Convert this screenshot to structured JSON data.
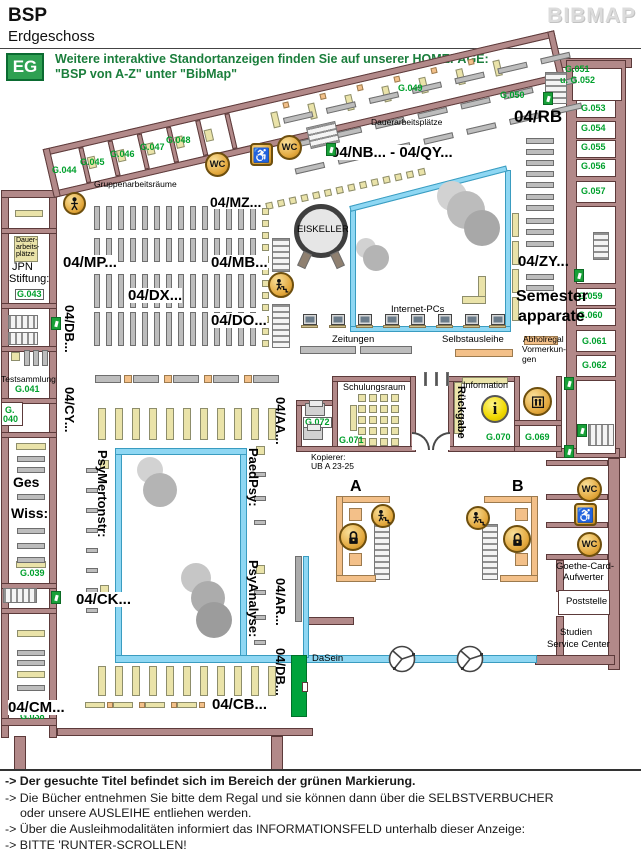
{
  "header": {
    "title": "BSP",
    "subtitle": "Erdgeschoss",
    "brand": "BIBMAP"
  },
  "notice": {
    "badge": "EG",
    "line1": "Weitere interaktive Standortanzeigen finden Sie auf unserer HOMEPAGE:",
    "line2": "\"BSP von A-Z\" unter \"BibMap\""
  },
  "legend_footer": {
    "lines": [
      {
        "text": "-> Der gesuchte Titel befindet sich im Bereich der grünen Markierung."
      },
      {
        "text": "-> Die Bücher entnehmen Sie bitte dem Regal und sie können dann über die SELBSTVERBUCHER"
      },
      {
        "text": "oder unsere AUSLEIHE entliehen werden."
      },
      {
        "text": "-> Über die Ausleihmodalitäten informiert das INFORMATIONSFELD unterhalb dieser Anzeige:"
      },
      {
        "text": "-> BITTE 'RUNTER-SCROLLEN!"
      }
    ]
  },
  "colors": {
    "wall": "#b28989",
    "glass_blue": "#8ed7f3",
    "marking_green": "#00a33c",
    "furniture_yellow": "#eae3a9",
    "shelf_gray": "#bdbdbd",
    "accent_orange": "#f3c089",
    "icon_gold": "#eec055",
    "room_label_green": "#00a02c",
    "notice_green": "#1b7e3c"
  },
  "map": {
    "marking": {
      "shelf": "04/DB...",
      "note": "green marking = location of searched title"
    },
    "labels": [
      {
        "t": "Gruppenarbeitsräume",
        "x": 94,
        "y": 180,
        "c": "S",
        "fs": 8.5
      },
      {
        "t": "Dauerarbeitsplätze",
        "x": 371,
        "y": 118,
        "c": "S",
        "fs": 8.5
      },
      {
        "t": "EISKELLER",
        "x": 297,
        "y": 225,
        "c": "S",
        "fs": 9.5,
        "n": "eiskeller-label"
      },
      {
        "t": "Internet-PCs",
        "x": 391,
        "y": 305,
        "c": "S",
        "fs": 9.5
      },
      {
        "t": "Zeitungen",
        "x": 332,
        "y": 335,
        "c": "S",
        "fs": 9.5
      },
      {
        "t": "Selbstausleihe",
        "x": 442,
        "y": 335,
        "c": "S",
        "fs": 9.5
      },
      {
        "t": "Abholregal",
        "x": 523,
        "y": 335,
        "c": "S",
        "fs": 8.5
      },
      {
        "t": "Vormerkun-",
        "x": 522,
        "y": 345,
        "c": "S",
        "fs": 8.5
      },
      {
        "t": "gen",
        "x": 522,
        "y": 355,
        "c": "S",
        "fs": 8.5
      },
      {
        "t": "Schulungsraum",
        "x": 343,
        "y": 383,
        "c": "S",
        "fs": 9
      },
      {
        "t": "Information",
        "x": 463,
        "y": 381,
        "c": "S",
        "fs": 9
      },
      {
        "t": "Kopierer:",
        "x": 311,
        "y": 453,
        "c": "S",
        "fs": 8.5
      },
      {
        "t": "UB A 23-25",
        "x": 311,
        "y": 462,
        "c": "S",
        "fs": 8.5
      },
      {
        "t": "DaSein",
        "x": 312,
        "y": 654,
        "c": "S",
        "fs": 9.5
      },
      {
        "t": "Goethe-Card-",
        "x": 556,
        "y": 562,
        "c": "S",
        "fs": 9.5
      },
      {
        "t": "Aufwerter",
        "x": 563,
        "y": 573,
        "c": "S",
        "fs": 9.5
      },
      {
        "t": "Poststelle",
        "x": 566,
        "y": 597,
        "c": "S",
        "fs": 9.5
      },
      {
        "t": "Studien",
        "x": 560,
        "y": 628,
        "c": "S",
        "fs": 9.5
      },
      {
        "t": "Service Center",
        "x": 547,
        "y": 640,
        "c": "S",
        "fs": 9.5
      },
      {
        "t": "JPN",
        "x": 12,
        "y": 262,
        "c": "S",
        "fs": 11
      },
      {
        "t": "Stiftung:",
        "x": 9,
        "y": 274,
        "c": "S",
        "fs": 11
      },
      {
        "t": "Testsammlung",
        "x": 1,
        "y": 375,
        "c": "S",
        "fs": 8.5
      },
      {
        "t": "Dauer-",
        "x": 16,
        "y": 237,
        "c": "S",
        "fs": 7
      },
      {
        "t": "arbeits-",
        "x": 16,
        "y": 244,
        "c": "S",
        "fs": 7
      },
      {
        "t": "plätze",
        "x": 16,
        "y": 251,
        "c": "S",
        "fs": 7
      },
      {
        "t": "G.044",
        "x": 52,
        "y": 166,
        "c": "G"
      },
      {
        "t": "G.045",
        "x": 80,
        "y": 158,
        "c": "G"
      },
      {
        "t": "G.046",
        "x": 110,
        "y": 150,
        "c": "G"
      },
      {
        "t": "G.047",
        "x": 140,
        "y": 143,
        "c": "G"
      },
      {
        "t": "G.048",
        "x": 166,
        "y": 136,
        "c": "G"
      },
      {
        "t": "G.049",
        "x": 398,
        "y": 84,
        "c": "G"
      },
      {
        "t": "G.050",
        "x": 500,
        "y": 91,
        "c": "G"
      },
      {
        "t": "G.051",
        "x": 565,
        "y": 65,
        "c": "G"
      },
      {
        "t": "u. G.052",
        "x": 560,
        "y": 76,
        "c": "G"
      },
      {
        "t": "G.053",
        "x": 581,
        "y": 104,
        "c": "G"
      },
      {
        "t": "G.054",
        "x": 581,
        "y": 124,
        "c": "G"
      },
      {
        "t": "G.055",
        "x": 581,
        "y": 143,
        "c": "G"
      },
      {
        "t": "G.056",
        "x": 581,
        "y": 162,
        "c": "G"
      },
      {
        "t": "G.057",
        "x": 581,
        "y": 187,
        "c": "G"
      },
      {
        "t": "G.059",
        "x": 578,
        "y": 292,
        "c": "G"
      },
      {
        "t": "G.060",
        "x": 578,
        "y": 311,
        "c": "G"
      },
      {
        "t": "G.061",
        "x": 582,
        "y": 337,
        "c": "G"
      },
      {
        "t": "G.062",
        "x": 582,
        "y": 361,
        "c": "G"
      },
      {
        "t": "G.043",
        "x": 15,
        "y": 289,
        "c": "G",
        "box": true
      },
      {
        "t": "G.041",
        "x": 15,
        "y": 385,
        "c": "G"
      },
      {
        "t": "G.",
        "x": 5,
        "y": 406,
        "c": "G"
      },
      {
        "t": "040",
        "x": 3,
        "y": 415,
        "c": "G"
      },
      {
        "t": "G.039",
        "x": 20,
        "y": 569,
        "c": "G"
      },
      {
        "t": "G.038",
        "x": 20,
        "y": 712,
        "c": "G"
      },
      {
        "t": "G.071",
        "x": 339,
        "y": 436,
        "c": "G"
      },
      {
        "t": "G.072",
        "x": 303,
        "y": 417,
        "c": "G",
        "box": true
      },
      {
        "t": "G.070",
        "x": 486,
        "y": 433,
        "c": "G"
      },
      {
        "t": "G.069",
        "x": 525,
        "y": 433,
        "c": "G"
      },
      {
        "t": "04/NB... - 04/QY...",
        "x": 331,
        "y": 145,
        "c": "B",
        "bg": "#fff"
      },
      {
        "t": "04/MZ...",
        "x": 210,
        "y": 195,
        "c": "B",
        "fs": 14,
        "bg": "#fff"
      },
      {
        "t": "04/RB",
        "x": 514,
        "y": 108,
        "c": "B",
        "fs": 17
      },
      {
        "t": "04/MP...",
        "x": 63,
        "y": 255,
        "c": "B",
        "bg": "#fff"
      },
      {
        "t": "04/MB...",
        "x": 211,
        "y": 255,
        "c": "B",
        "bg": "#fff"
      },
      {
        "t": "04/DX...",
        "x": 128,
        "y": 288,
        "c": "B",
        "bg": "#fff"
      },
      {
        "t": "04/DO...",
        "x": 211,
        "y": 313,
        "c": "B",
        "bg": "#fff"
      },
      {
        "t": "04/ZY...",
        "x": 518,
        "y": 254,
        "c": "B"
      },
      {
        "t": "Semester",
        "x": 516,
        "y": 289,
        "c": "B",
        "fs": 16
      },
      {
        "t": "apparate",
        "x": 518,
        "y": 309,
        "c": "B",
        "fs": 16
      },
      {
        "t": "04/CK...",
        "x": 76,
        "y": 592,
        "c": "B",
        "bg": "#fff"
      },
      {
        "t": "04/CM...",
        "x": 8,
        "y": 700,
        "c": "B",
        "bg": "#fff"
      },
      {
        "t": "04/CB...",
        "x": 212,
        "y": 697,
        "c": "B",
        "bg": "#fff"
      },
      {
        "t": "A",
        "x": 350,
        "y": 479,
        "c": "B",
        "fs": 16,
        "n": "staircase-a-label"
      },
      {
        "t": "B",
        "x": 512,
        "y": 479,
        "c": "B",
        "fs": 16,
        "n": "staircase-b-label"
      },
      {
        "t": "Ges",
        "x": 13,
        "y": 475,
        "c": "B",
        "fs": 14
      },
      {
        "t": "Wiss:",
        "x": 11,
        "y": 506,
        "c": "B",
        "fs": 14
      },
      {
        "t": "04/DB...",
        "x": 63,
        "y": 305,
        "c": "V"
      },
      {
        "t": "04/CY...",
        "x": 63,
        "y": 387,
        "c": "V"
      },
      {
        "t": "04/AA...",
        "x": 274,
        "y": 397,
        "c": "V"
      },
      {
        "t": "04/AR...",
        "x": 274,
        "y": 578,
        "c": "V"
      },
      {
        "t": "04/DB...",
        "x": 274,
        "y": 648,
        "c": "V",
        "n": "marked-shelf-label"
      },
      {
        "t": "PsyMertonstr:",
        "x": 96,
        "y": 450,
        "c": "V"
      },
      {
        "t": "PaedPsy:",
        "x": 247,
        "y": 448,
        "c": "V"
      },
      {
        "t": "PsyAnalyse:",
        "x": 247,
        "y": 560,
        "c": "V"
      },
      {
        "t": "Rückgabe",
        "x": 455,
        "y": 386,
        "c": "V",
        "fs": 11
      }
    ],
    "icons": [
      {
        "kind": "person",
        "name": "baby-changing-icon",
        "x": 63,
        "y": 192,
        "s": 23
      },
      {
        "kind": "wc",
        "name": "wc-icon",
        "x": 205,
        "y": 152,
        "s": 25
      },
      {
        "kind": "wheel",
        "name": "accessible-wc-icon",
        "x": 250,
        "y": 143,
        "s": 23
      },
      {
        "kind": "wc",
        "name": "wc-icon",
        "x": 277,
        "y": 135,
        "s": 25
      },
      {
        "kind": "stairp",
        "name": "stairs-up-icon",
        "x": 268,
        "y": 272,
        "s": 26
      },
      {
        "kind": "info",
        "name": "information-icon",
        "x": 481,
        "y": 395,
        "s": 28
      },
      {
        "kind": "elev",
        "name": "elevator-icon",
        "x": 523,
        "y": 387,
        "s": 29
      },
      {
        "kind": "lock",
        "name": "lock-icon",
        "x": 339,
        "y": 523,
        "s": 28
      },
      {
        "kind": "lock",
        "name": "lock-icon",
        "x": 503,
        "y": 525,
        "s": 28
      },
      {
        "kind": "stairp",
        "name": "stairs-up-icon",
        "x": 371,
        "y": 504,
        "s": 24
      },
      {
        "kind": "stairp",
        "name": "stairs-up-icon",
        "x": 466,
        "y": 506,
        "s": 24
      },
      {
        "kind": "wc",
        "name": "wc-icon",
        "x": 577,
        "y": 477,
        "s": 25
      },
      {
        "kind": "wheel",
        "name": "accessible-wc-icon",
        "x": 574,
        "y": 503,
        "s": 23
      },
      {
        "kind": "wc",
        "name": "wc-icon",
        "x": 577,
        "y": 532,
        "s": 25
      },
      {
        "kind": "exit",
        "name": "emergency-exit-icon",
        "x": 326,
        "y": 143
      },
      {
        "kind": "exit",
        "name": "emergency-exit-icon",
        "x": 543,
        "y": 92
      },
      {
        "kind": "exit",
        "name": "emergency-exit-icon",
        "x": 51,
        "y": 317
      },
      {
        "kind": "exit",
        "name": "emergency-exit-icon",
        "x": 51,
        "y": 591
      },
      {
        "kind": "exit",
        "name": "emergency-exit-icon",
        "x": 574,
        "y": 269
      },
      {
        "kind": "exit",
        "name": "emergency-exit-icon",
        "x": 564,
        "y": 377
      },
      {
        "kind": "exit",
        "name": "emergency-exit-icon",
        "x": 577,
        "y": 424
      },
      {
        "kind": "exit",
        "name": "emergency-exit-icon",
        "x": 564,
        "y": 445
      },
      {
        "kind": "printer",
        "name": "copier-icon",
        "x": 305,
        "y": 403
      },
      {
        "kind": "printer",
        "name": "copier-icon",
        "x": 303,
        "y": 427
      },
      {
        "kind": "pc",
        "name": "internet-pc-icon",
        "x": 301,
        "y": 314
      },
      {
        "kind": "pc",
        "name": "internet-pc-icon",
        "x": 329,
        "y": 314
      },
      {
        "kind": "pc",
        "name": "internet-pc-icon",
        "x": 356,
        "y": 314
      },
      {
        "kind": "pc",
        "name": "internet-pc-icon",
        "x": 383,
        "y": 314
      },
      {
        "kind": "pc",
        "name": "internet-pc-icon",
        "x": 409,
        "y": 314
      },
      {
        "kind": "pc",
        "name": "internet-pc-icon",
        "x": 436,
        "y": 314
      },
      {
        "kind": "pc",
        "name": "internet-pc-icon",
        "x": 463,
        "y": 314
      },
      {
        "kind": "pc",
        "name": "internet-pc-icon",
        "x": 489,
        "y": 314
      },
      {
        "kind": "door",
        "name": "revolving-door-icon",
        "x": 387,
        "y": 644
      },
      {
        "kind": "door",
        "name": "revolving-door-icon",
        "x": 455,
        "y": 644
      }
    ]
  }
}
